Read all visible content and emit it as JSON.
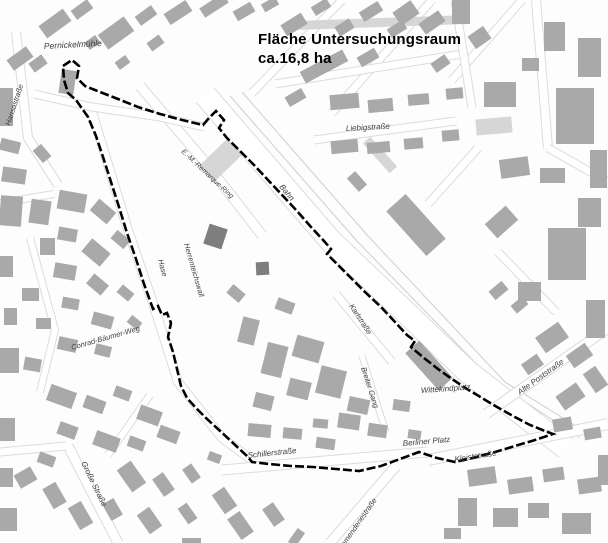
{
  "title": {
    "line1": "Fläche Untersuchungsraum",
    "line2": "ca.16,8 ha"
  },
  "colors": {
    "background": "#fdfdfd",
    "building": "#a9a9a9",
    "building_light": "#d6d6d6",
    "building_dark": "#7e7e7e",
    "road_fill": "#ffffff",
    "road_casing": "#dcdcdc",
    "rail_line": "#cfcfcf",
    "boundary": "#000000",
    "label": "#3d3d3d",
    "title": "#000000"
  },
  "boundary": {
    "name": "Untersuchungsraum-Grenze",
    "points": "63,66 72,60 79,66 77,78 85,86 100,92 118,99 138,107 160,114 182,120 203,125 209,118 216,111 224,120 219,128 227,138 240,151 254,165 268,180 283,196 297,211 311,227 324,241 331,249 327,254 338,265 352,279 366,293 381,307 395,322 407,335 415,341 411,347 424,358 438,369 452,379 467,389 482,398 497,407 513,416 530,425 545,431 553,434 535,440 515,446 495,452 473,458 455,462 437,458 419,452 400,459 381,466 359,471 336,469 313,467 291,466 269,464 252,462 247,456 233,443 219,430 206,418 196,408 187,398 181,386 177,369 173,352 168,337 171,323 167,313 162,315 158,306 153,309 144,284 136,259 127,233 119,207 111,182 104,160 96,136 88,117 76,100 68,93 64,80",
    "stroke_width": 2.6,
    "dash": "9 3"
  },
  "labels": [
    {
      "t": "Pernickelmühle",
      "x": 44,
      "y": 49,
      "r": -3,
      "s": 8.5
    },
    {
      "t": "Hansastraße",
      "x": 10,
      "y": 126,
      "r": -72,
      "s": 7.5
    },
    {
      "t": "E.-M.-Remarque-Ring",
      "x": 181,
      "y": 152,
      "r": 43,
      "s": 7
    },
    {
      "t": "Bahn",
      "x": 279,
      "y": 187,
      "r": 50,
      "s": 8
    },
    {
      "t": "Liebigstraße",
      "x": 346,
      "y": 131,
      "r": -3,
      "s": 8
    },
    {
      "t": "Hase",
      "x": 158,
      "y": 260,
      "r": 75,
      "s": 7.5
    },
    {
      "t": "Herrenteichswall",
      "x": 184,
      "y": 244,
      "r": 74,
      "s": 7.5
    },
    {
      "t": "Conrad-Bäumer-Weg",
      "x": 72,
      "y": 350,
      "r": -16,
      "s": 7.5
    },
    {
      "t": "Karlstraße",
      "x": 349,
      "y": 306,
      "r": 57,
      "s": 7.5
    },
    {
      "t": "Breiter Gang",
      "x": 361,
      "y": 368,
      "r": 72,
      "s": 7.5
    },
    {
      "t": "Wittekindplatz",
      "x": 421,
      "y": 393,
      "r": -4,
      "s": 8
    },
    {
      "t": "Alte Poststraße",
      "x": 520,
      "y": 395,
      "r": -36,
      "s": 8
    },
    {
      "t": "Berliner Platz",
      "x": 403,
      "y": 446,
      "r": -5,
      "s": 8
    },
    {
      "t": "Kleiststraße",
      "x": 455,
      "y": 462,
      "r": -9,
      "s": 8
    },
    {
      "t": "Schillerstraße",
      "x": 248,
      "y": 458,
      "r": -6,
      "s": 8
    },
    {
      "t": "Große Straße",
      "x": 81,
      "y": 463,
      "r": 64,
      "s": 8
    },
    {
      "t": "Kommenderiestraße",
      "x": 338,
      "y": 556,
      "r": -55,
      "s": 7.5
    }
  ],
  "roads": [
    {
      "pts": [
        [
          205,
          95
        ],
        [
          330,
          240
        ],
        [
          468,
          372
        ],
        [
          566,
          448
        ]
      ],
      "w": 22
    },
    {
      "pts": [
        [
          140,
          86
        ],
        [
          205,
          162
        ],
        [
          262,
          235
        ]
      ],
      "w": 9
    },
    {
      "pts": [
        [
          92,
          112
        ],
        [
          128,
          230
        ],
        [
          152,
          300
        ],
        [
          178,
          382
        ],
        [
          222,
          438
        ],
        [
          252,
          460
        ]
      ],
      "w": 8
    },
    {
      "pts": [
        [
          16,
          32
        ],
        [
          28,
          138
        ],
        [
          58,
          185
        ]
      ],
      "w": 8
    },
    {
      "pts": [
        [
          34,
          94
        ],
        [
          92,
          107
        ],
        [
          160,
          117
        ],
        [
          204,
          127
        ]
      ],
      "w": 7
    },
    {
      "pts": [
        [
          314,
          140
        ],
        [
          456,
          121
        ]
      ],
      "w": 7
    },
    {
      "pts": [
        [
          342,
          0
        ],
        [
          252,
          93
        ]
      ],
      "w": 7
    },
    {
      "pts": [
        [
          432,
          0
        ],
        [
          332,
          113
        ]
      ],
      "w": 7
    },
    {
      "pts": [
        [
          522,
          0
        ],
        [
          452,
          80
        ]
      ],
      "w": 7
    },
    {
      "pts": [
        [
          275,
          84
        ],
        [
          462,
          54
        ]
      ],
      "w": 7
    },
    {
      "pts": [
        [
          455,
          0
        ],
        [
          472,
          108
        ]
      ],
      "w": 7
    },
    {
      "pts": [
        [
          536,
          0
        ],
        [
          548,
          148
        ]
      ],
      "w": 8
    },
    {
      "pts": [
        [
          548,
          148
        ],
        [
          608,
          182
        ]
      ],
      "w": 7
    },
    {
      "pts": [
        [
          478,
          148
        ],
        [
          428,
          204
        ]
      ],
      "w": 7
    },
    {
      "pts": [
        [
          498,
          252
        ],
        [
          556,
          312
        ]
      ],
      "w": 7
    },
    {
      "pts": [
        [
          486,
          414
        ],
        [
          608,
          328
        ]
      ],
      "w": 9
    },
    {
      "pts": [
        [
          428,
          460
        ],
        [
          608,
          424
        ]
      ],
      "w": 10
    },
    {
      "pts": [
        [
          222,
          470
        ],
        [
          428,
          452
        ]
      ],
      "w": 9
    },
    {
      "pts": [
        [
          68,
          446
        ],
        [
          118,
          543
        ]
      ],
      "w": 9
    },
    {
      "pts": [
        [
          396,
          466
        ],
        [
          330,
          543
        ]
      ],
      "w": 9
    },
    {
      "pts": [
        [
          336,
          294
        ],
        [
          392,
          362
        ]
      ],
      "w": 7
    },
    {
      "pts": [
        [
          362,
          356
        ],
        [
          386,
          432
        ]
      ],
      "w": 5
    },
    {
      "pts": [
        [
          0,
          452
        ],
        [
          66,
          446
        ]
      ],
      "w": 7
    },
    {
      "pts": [
        [
          0,
          203
        ],
        [
          54,
          194
        ]
      ],
      "w": 6
    },
    {
      "pts": [
        [
          30,
          238
        ],
        [
          55,
          330
        ],
        [
          40,
          392
        ]
      ],
      "w": 6
    },
    {
      "pts": [
        [
          150,
          395
        ],
        [
          108,
          455
        ]
      ],
      "w": 6
    }
  ],
  "rails": [
    {
      "pts": [
        [
          216,
          102
        ],
        [
          340,
          248
        ],
        [
          475,
          378
        ],
        [
          566,
          444
        ]
      ]
    },
    {
      "pts": [
        [
          230,
          96
        ],
        [
          356,
          240
        ],
        [
          492,
          380
        ],
        [
          580,
          438
        ]
      ]
    },
    {
      "pts": [
        [
          242,
          92
        ],
        [
          368,
          236
        ],
        [
          505,
          382
        ],
        [
          592,
          436
        ]
      ]
    },
    {
      "pts": [
        [
          222,
          112
        ],
        [
          344,
          256
        ],
        [
          470,
          382
        ]
      ]
    }
  ],
  "buildings": {
    "gray": [
      [
        40,
        16,
        30,
        15,
        -36
      ],
      [
        72,
        4,
        20,
        11,
        -36
      ],
      [
        8,
        52,
        24,
        13,
        -36
      ],
      [
        30,
        58,
        16,
        11,
        -36
      ],
      [
        0,
        88,
        13,
        38,
        0
      ],
      [
        60,
        70,
        15,
        24,
        8
      ],
      [
        86,
        38,
        13,
        9,
        -36
      ],
      [
        0,
        140,
        20,
        12,
        14
      ],
      [
        2,
        168,
        24,
        15,
        8
      ],
      [
        34,
        148,
        16,
        11,
        50
      ],
      [
        0,
        196,
        22,
        30,
        4
      ],
      [
        30,
        200,
        20,
        24,
        8
      ],
      [
        100,
        24,
        32,
        18,
        -36
      ],
      [
        136,
        10,
        20,
        11,
        -36
      ],
      [
        148,
        38,
        15,
        10,
        -36
      ],
      [
        116,
        58,
        13,
        9,
        -36
      ],
      [
        165,
        6,
        26,
        13,
        -33
      ],
      [
        200,
        0,
        28,
        11,
        -33
      ],
      [
        234,
        6,
        20,
        11,
        -30
      ],
      [
        262,
        0,
        16,
        9,
        -30
      ],
      [
        282,
        18,
        24,
        13,
        -32
      ],
      [
        312,
        2,
        18,
        10,
        -32
      ],
      [
        336,
        22,
        17,
        11,
        -32
      ],
      [
        360,
        6,
        22,
        11,
        -32
      ],
      [
        388,
        24,
        18,
        10,
        -32
      ],
      [
        300,
        60,
        48,
        13,
        -28
      ],
      [
        358,
        52,
        20,
        11,
        -30
      ],
      [
        398,
        2,
        16,
        22,
        55
      ],
      [
        420,
        16,
        24,
        13,
        -35
      ],
      [
        452,
        0,
        18,
        24,
        0
      ],
      [
        472,
        28,
        15,
        19,
        55
      ],
      [
        432,
        58,
        17,
        11,
        -35
      ],
      [
        484,
        82,
        32,
        25,
        0
      ],
      [
        522,
        58,
        17,
        13,
        0
      ],
      [
        544,
        22,
        21,
        29,
        0
      ],
      [
        578,
        38,
        23,
        39,
        0
      ],
      [
        556,
        88,
        38,
        56,
        0
      ],
      [
        590,
        150,
        17,
        38,
        0
      ],
      [
        286,
        92,
        19,
        11,
        -30
      ],
      [
        330,
        94,
        29,
        15,
        -5
      ],
      [
        368,
        99,
        25,
        13,
        -5
      ],
      [
        408,
        94,
        21,
        11,
        -5
      ],
      [
        446,
        88,
        17,
        11,
        -5
      ],
      [
        331,
        140,
        27,
        13,
        -5
      ],
      [
        367,
        142,
        23,
        11,
        -5
      ],
      [
        404,
        138,
        19,
        11,
        -5
      ],
      [
        442,
        130,
        17,
        11,
        -5
      ],
      [
        500,
        158,
        29,
        19,
        -8
      ],
      [
        540,
        168,
        25,
        15,
        0
      ],
      [
        578,
        198,
        23,
        29,
        0
      ],
      [
        492,
        208,
        19,
        28,
        48
      ],
      [
        548,
        228,
        38,
        52,
        0
      ],
      [
        518,
        282,
        23,
        19,
        0
      ],
      [
        586,
        300,
        19,
        38,
        0
      ],
      [
        490,
        285,
        17,
        11,
        -40
      ],
      [
        512,
        300,
        15,
        10,
        -40
      ],
      [
        386,
        212,
        60,
        26,
        48
      ],
      [
        348,
        176,
        18,
        11,
        48
      ],
      [
        58,
        192,
        28,
        19,
        10
      ],
      [
        92,
        204,
        22,
        15,
        40
      ],
      [
        58,
        228,
        19,
        13,
        10
      ],
      [
        84,
        244,
        24,
        17,
        40
      ],
      [
        112,
        234,
        17,
        11,
        40
      ],
      [
        54,
        264,
        22,
        15,
        10
      ],
      [
        88,
        278,
        19,
        13,
        40
      ],
      [
        118,
        288,
        15,
        10,
        40
      ],
      [
        62,
        298,
        17,
        11,
        10
      ],
      [
        92,
        314,
        21,
        13,
        15
      ],
      [
        128,
        318,
        13,
        9,
        40
      ],
      [
        40,
        238,
        15,
        17,
        0
      ],
      [
        22,
        288,
        17,
        13,
        0
      ],
      [
        36,
        318,
        15,
        11,
        0
      ],
      [
        0,
        256,
        13,
        21,
        0
      ],
      [
        4,
        308,
        13,
        17,
        0
      ],
      [
        0,
        348,
        19,
        25,
        0
      ],
      [
        24,
        358,
        17,
        13,
        10
      ],
      [
        58,
        338,
        19,
        13,
        12
      ],
      [
        95,
        345,
        16,
        11,
        14
      ],
      [
        240,
        318,
        17,
        26,
        14
      ],
      [
        264,
        344,
        21,
        32,
        14
      ],
      [
        294,
        338,
        28,
        22,
        16
      ],
      [
        318,
        368,
        26,
        28,
        14
      ],
      [
        288,
        380,
        22,
        18,
        14
      ],
      [
        254,
        394,
        19,
        15,
        14
      ],
      [
        348,
        398,
        21,
        15,
        12
      ],
      [
        228,
        288,
        16,
        11,
        40
      ],
      [
        276,
        300,
        18,
        12,
        20
      ],
      [
        338,
        414,
        22,
        15,
        8
      ],
      [
        368,
        424,
        19,
        13,
        8
      ],
      [
        393,
        400,
        17,
        11,
        8
      ],
      [
        408,
        430,
        13,
        9,
        8
      ],
      [
        316,
        438,
        19,
        11,
        8
      ],
      [
        404,
        356,
        50,
        19,
        48
      ],
      [
        538,
        328,
        28,
        19,
        -35
      ],
      [
        568,
        348,
        23,
        15,
        -35
      ],
      [
        523,
        358,
        19,
        13,
        -35
      ],
      [
        558,
        388,
        25,
        17,
        -35
      ],
      [
        588,
        368,
        15,
        23,
        -35
      ],
      [
        553,
        418,
        19,
        13,
        -10
      ],
      [
        584,
        428,
        17,
        11,
        -10
      ],
      [
        468,
        468,
        28,
        17,
        -8
      ],
      [
        508,
        478,
        25,
        15,
        -8
      ],
      [
        543,
        468,
        21,
        13,
        -8
      ],
      [
        578,
        478,
        23,
        15,
        -8
      ],
      [
        458,
        498,
        19,
        28,
        0
      ],
      [
        493,
        508,
        25,
        19,
        0
      ],
      [
        528,
        503,
        21,
        15,
        0
      ],
      [
        562,
        513,
        29,
        21,
        0
      ],
      [
        444,
        528,
        17,
        11,
        0
      ],
      [
        598,
        455,
        10,
        30,
        0
      ],
      [
        48,
        388,
        27,
        17,
        20
      ],
      [
        84,
        398,
        21,
        13,
        20
      ],
      [
        114,
        388,
        17,
        11,
        20
      ],
      [
        138,
        408,
        23,
        15,
        20
      ],
      [
        58,
        424,
        19,
        13,
        20
      ],
      [
        94,
        434,
        25,
        15,
        20
      ],
      [
        128,
        438,
        17,
        11,
        20
      ],
      [
        158,
        428,
        21,
        13,
        20
      ],
      [
        38,
        454,
        17,
        11,
        20
      ],
      [
        118,
        468,
        27,
        17,
        55
      ],
      [
        153,
        478,
        21,
        13,
        55
      ],
      [
        183,
        468,
        17,
        11,
        55
      ],
      [
        43,
        488,
        23,
        15,
        60
      ],
      [
        18,
        468,
        15,
        19,
        60
      ],
      [
        68,
        508,
        25,
        15,
        60
      ],
      [
        103,
        503,
        19,
        13,
        60
      ],
      [
        138,
        513,
        23,
        15,
        55
      ],
      [
        178,
        508,
        19,
        11,
        55
      ],
      [
        213,
        493,
        23,
        15,
        55
      ],
      [
        0,
        418,
        15,
        23,
        0
      ],
      [
        0,
        468,
        13,
        19,
        0
      ],
      [
        0,
        508,
        17,
        23,
        0
      ],
      [
        208,
        453,
        13,
        9,
        20
      ],
      [
        228,
        518,
        25,
        15,
        55
      ],
      [
        263,
        508,
        21,
        13,
        55
      ],
      [
        182,
        538,
        19,
        9,
        0
      ],
      [
        248,
        424,
        23,
        13,
        5
      ],
      [
        283,
        428,
        19,
        11,
        5
      ],
      [
        313,
        419,
        15,
        9,
        5
      ],
      [
        288,
        533,
        17,
        9,
        -55
      ]
    ],
    "light": [
      [
        298,
        18,
        168,
        9,
        -2
      ],
      [
        476,
        118,
        36,
        16,
        -5
      ],
      [
        360,
        150,
        40,
        10,
        48
      ],
      [
        210,
        140,
        22,
        40,
        46
      ]
    ],
    "dark": [
      [
        206,
        226,
        19,
        21,
        18
      ],
      [
        256,
        262,
        13,
        13,
        -3
      ]
    ]
  }
}
